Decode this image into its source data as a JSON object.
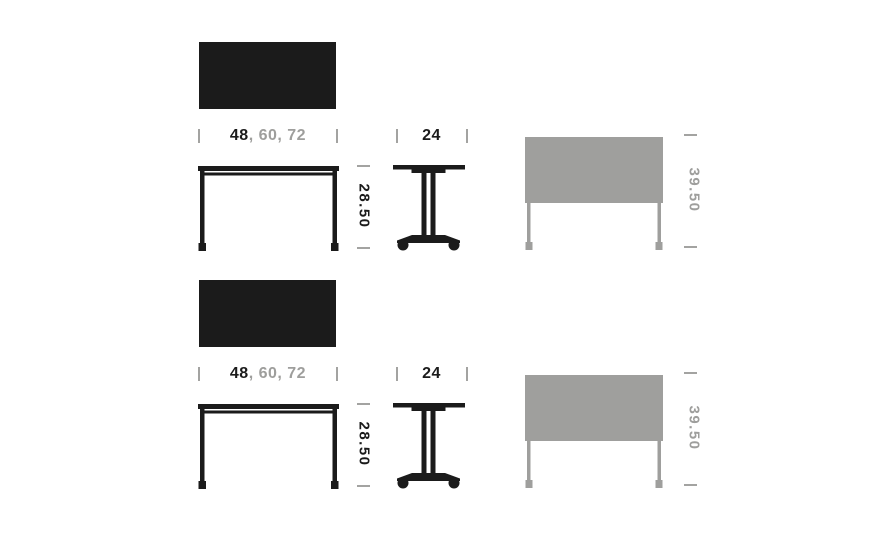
{
  "page": {
    "background": "#ffffff"
  },
  "colors": {
    "page_bg": "#ffffff",
    "figure_black": "#1b1b1b",
    "figure_gray": "#9f9f9d",
    "dim_primary": "#1b1b1b",
    "dim_secondary": "#9e9e9c",
    "tick": "#a3a3a1"
  },
  "rows": [
    {
      "name": "table-spec-row-1",
      "width": {
        "primary": "48",
        "secondary": ", 60, 72"
      },
      "depth": "24",
      "height": "28.50",
      "nested_height": "39.50"
    },
    {
      "name": "table-spec-row-2",
      "width": {
        "primary": "48",
        "secondary": ", 60, 72"
      },
      "depth": "24",
      "height": "28.50",
      "nested_height": "39.50"
    }
  ]
}
